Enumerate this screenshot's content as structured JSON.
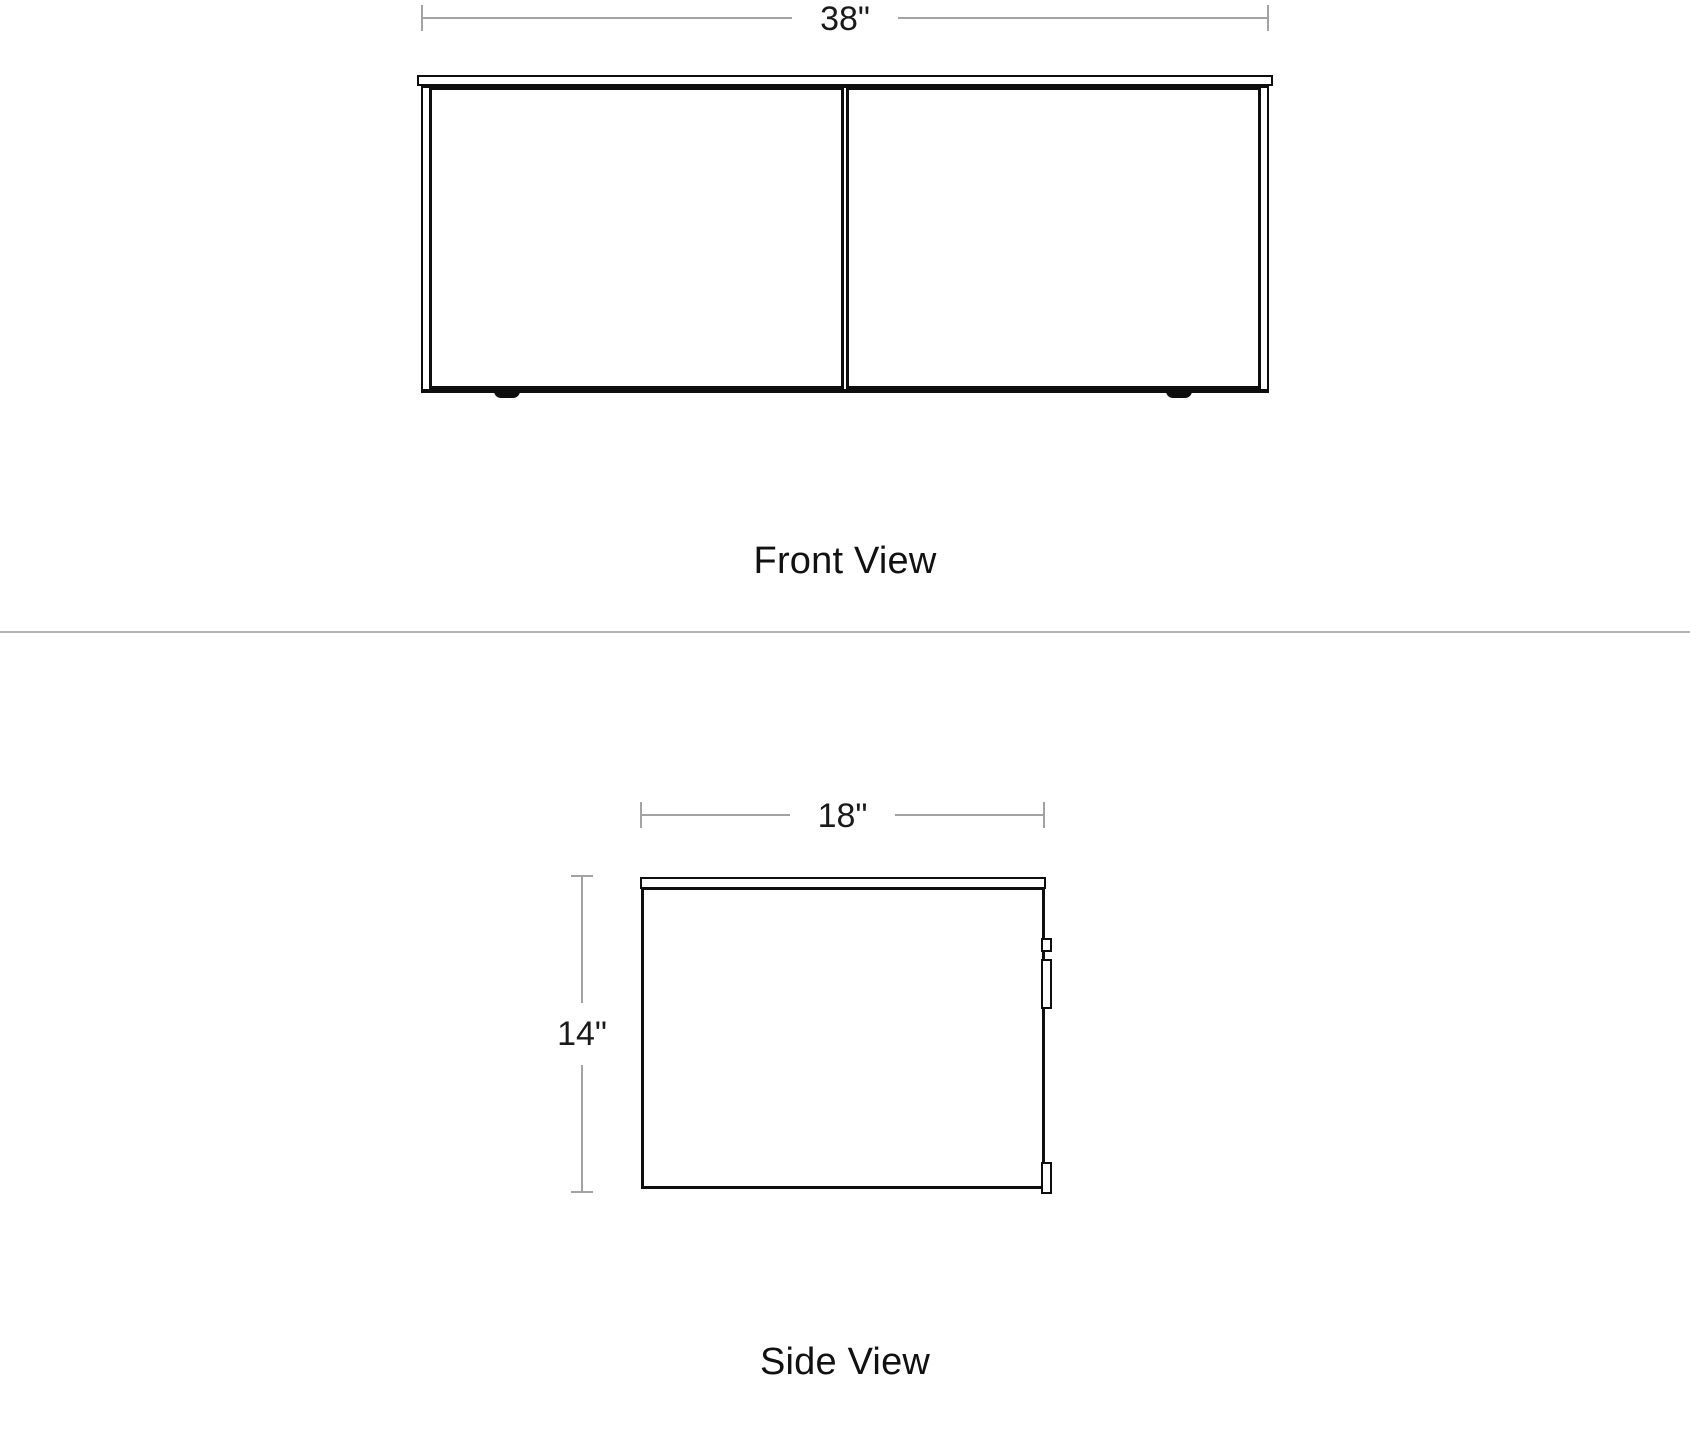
{
  "diagram": {
    "product": "two-door wall-mounted console drawing",
    "front": {
      "caption": "Front View",
      "width_dimension": "38\""
    },
    "side": {
      "caption": "Side View",
      "width_dimension": "18\"",
      "height_dimension": "14\""
    },
    "colors": {
      "background": "#ffffff",
      "drawing_line": "#0e0e0e",
      "dimension_line": "#a3a3a3",
      "text": "#1a1a1a",
      "separator": "#b3b3b3"
    }
  }
}
